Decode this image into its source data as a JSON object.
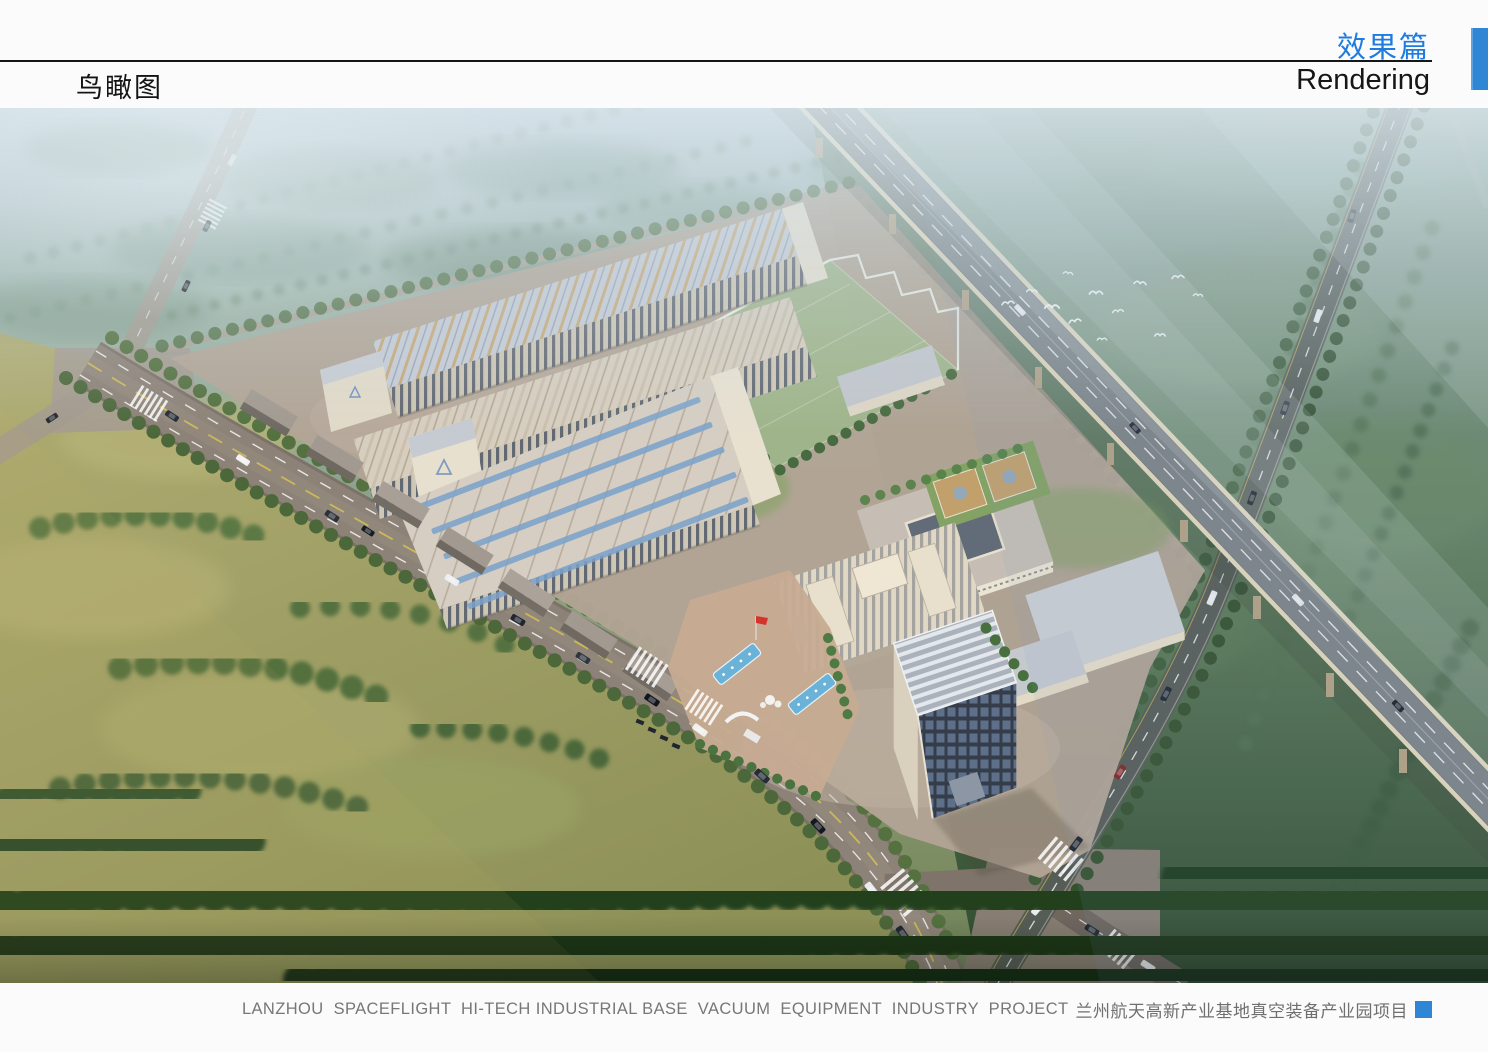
{
  "page": {
    "background": "#fbfbfb"
  },
  "header": {
    "album_title_zh": "效果篇",
    "album_title_en": "Rendering",
    "page_title_zh": "鸟瞰图",
    "accent_color": "#1e7ce0",
    "tab_color": "#2e86d5"
  },
  "figure": {
    "kind": "aerial-architectural-rendering",
    "subject_zh": "鸟瞰图",
    "palette": {
      "haze_sky": "#c3d3da",
      "forest_far": "#7f9c8d",
      "meadow": "#a8a76c",
      "forest_near": "#2c4527",
      "asphalt": "#8a7f75",
      "campus_pavement": "#b5a698",
      "factory_roof": "#cdd2d9",
      "facade_cream": "#e3dac6",
      "glass_field_green": "#9db789",
      "pool_blue": "#6ab2d8",
      "flag_red": "#d5342c",
      "viaduct_deck": "#757b7d"
    }
  },
  "footer": {
    "caption_en": "LANZHOU  SPACEFLIGHT  HI-TECH INDUSTRIAL BASE  VACUUM  EQUIPMENT  INDUSTRY  PROJECT",
    "caption_zh": "兰州航天高新产业基地真空装备产业园项目",
    "text_color": "#777777",
    "marker_color": "#2e86d5"
  }
}
